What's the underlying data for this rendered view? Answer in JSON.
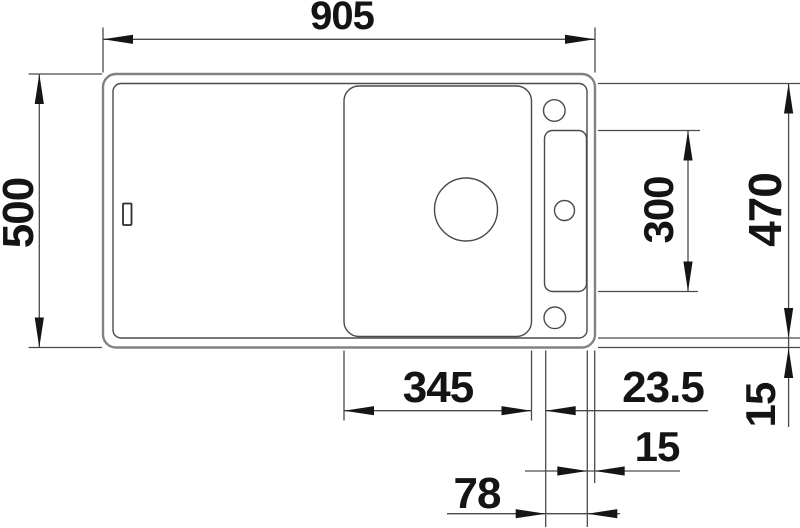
{
  "drawing": {
    "type": "technical-dimension-drawing",
    "subject": "Inset sink with cutting board and accessory ledge - top view",
    "units": "mm",
    "background": "#ffffff",
    "colors": {
      "outer_edge": "#828282",
      "line": "#4a4a4a",
      "arrow": "#151515",
      "text": "#141414"
    },
    "dimensions": {
      "overall_width": "905",
      "overall_depth": "500",
      "inner_depth": "470",
      "ledge_recess_length": "300",
      "board_width": "345",
      "board_to_ledge_gap": "23.5",
      "rim_width_right": "15",
      "rim_width_bottom": "15",
      "ledge_width": "78"
    }
  }
}
